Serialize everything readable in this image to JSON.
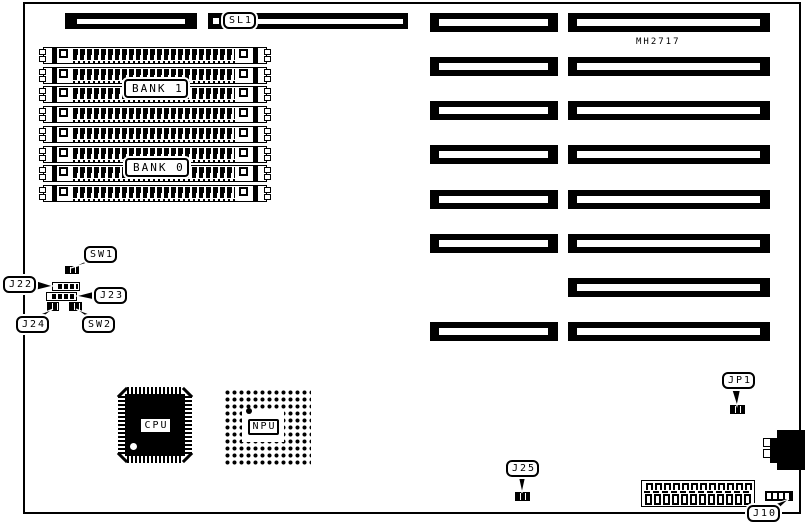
{
  "part_number": "MH2717",
  "callouts": {
    "sl1": "SL1",
    "sw1": "SW1",
    "sw2": "SW2",
    "j22": "J22",
    "j23": "J23",
    "j24": "J24",
    "j25": "J25",
    "jp1": "JP1",
    "j10": "J10"
  },
  "memory": {
    "bank0_label": "BANK 0",
    "bank1_label": "BANK 1",
    "simm_socket_count": 8
  },
  "expansion": {
    "row_count": 8
  },
  "chips": {
    "cpu_label": "CPU",
    "npu_label": "NPU"
  },
  "power_connector": {
    "pin_count": 12
  },
  "colors": {
    "ink": "#000000",
    "paper": "#ffffff"
  }
}
